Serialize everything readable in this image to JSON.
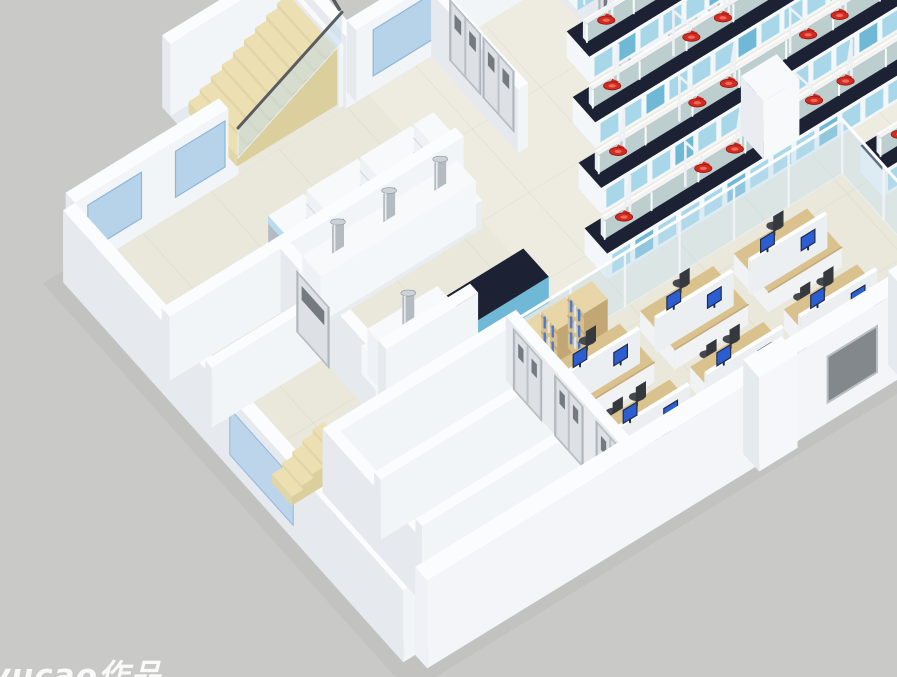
{
  "meta": {
    "description": "3D isometric cutaway render of a laboratory building floor plan: central lab hall with island benches and red fume-extraction arms, prep rooms with canopy hoods and chimney vents, top-right instrument rooms with a biosafety cabinet, an open-plan office with cubicle desks and monitors, corridor rooms with double doors, and two staircases.",
    "canvas": {
      "width": 897,
      "height": 677
    }
  },
  "watermark": {
    "text": "yucao作品",
    "color": "#ffffff"
  },
  "palette": {
    "background": "#c9c9c7",
    "shadow": "#bababa",
    "floor": "#eae7db",
    "floor_lab": "#f0eee3",
    "tile_line": "#d8d6c9",
    "wall_top": "#fbfcfe",
    "wall_left": "#e6eaef",
    "wall_front": "#f2f5f8",
    "wall_outer": "#eef1f5",
    "bench_top": "#1c2234",
    "bench_body": "#f3f7f9",
    "bench_blue": "#a7d7e9",
    "bench_teal": "#6fb9d6",
    "shelf_mint": "#d8ecea",
    "arm_white": "#eef1f3",
    "hood_red": "#d32b20",
    "hood_red_dark": "#9c1810",
    "hood_red_light": "#e96a5e",
    "glass": "#bfdcea",
    "glass_frame": "#e9eff3",
    "window_blue": "#b7d3ea",
    "window_blue_edge": "#8fb8d8",
    "window_gray": "#83888d",
    "door_face": "#dde1e5",
    "door_frame": "#aab1b7",
    "door_window": "#596066",
    "desk_tan": "#dac28f",
    "desk_edge": "#c3a978",
    "desk_body": "#f0f2f4",
    "partition": "#eceff2",
    "monitor_screen": "#2d5ed1",
    "monitor_dark": "#1f2c47",
    "chair": "#45494f",
    "chair_dark": "#35383d",
    "stair": "#ecdfb2",
    "stair_side": "#dccf9e",
    "stair_left": "#e2d5a8",
    "rail_dark": "#5a5d60",
    "wood": "#d8bf8b",
    "wood_dark": "#c2a674",
    "wood_top": "#e8d6a8",
    "book_blue": "#4a7bd4",
    "steel": "#b4bcc2",
    "steel_top": "#ccd3d8",
    "white": "#f7f9fb",
    "cab_blue": "#b8dcee",
    "cab_open": "#20283a"
  },
  "projection": {
    "origin": [
      75,
      275
    ],
    "u_axis": [
      0.852,
      -0.523
    ],
    "v_axis": [
      0.667,
      0.745
    ]
  },
  "building": {
    "length": 950,
    "width": 510,
    "wall_height": 72
  },
  "scene": {
    "stair_bay": {
      "u1": 180,
      "u2": 330,
      "v1": -99,
      "v2": 0,
      "steps": 9,
      "step_u0": 196,
      "step_du": 13,
      "sv1": -80,
      "sv2": -8,
      "rise": 5.5,
      "base_h": 6
    },
    "stairs_left": {
      "steps": 5,
      "u0": 8,
      "du": 12,
      "v1": 285,
      "v2": 315,
      "rise": 5,
      "base_h": 4
    },
    "nw_wall_segments": [
      [
        0,
        180
      ],
      [
        330,
        950
      ]
    ],
    "ext_windows": {
      "nw_u": [
        [
          15,
          78
        ],
        [
          118,
          176
        ],
        [
          350,
          420
        ],
        [
          588,
          640
        ],
        [
          694,
          746
        ],
        [
          804,
          856
        ],
        [
          900,
          944
        ]
      ],
      "sw_v": [
        [
          250,
          345
        ]
      ],
      "se_u": [
        [
          470,
          528
        ],
        [
          635,
          693
        ],
        [
          798,
          853
        ]
      ]
    },
    "interior_walls": {
      "upper": [
        [
          418,
          0,
          430,
          130,
          64
        ],
        [
          0,
          130,
          345,
          142,
          64
        ],
        [
          130,
          142,
          142,
          285,
          64
        ],
        [
          0,
          195,
          130,
          205,
          60
        ],
        [
          555,
          0,
          567,
          130,
          64
        ],
        [
          660,
          0,
          672,
          130,
          64
        ],
        [
          770,
          0,
          782,
          130,
          64
        ],
        [
          880,
          0,
          892,
          130,
          64
        ]
      ],
      "v130_segments": [
        [
          555,
          130,
          587,
          142,
          64
        ],
        [
          623,
          130,
          702,
          142,
          64
        ],
        [
          738,
          130,
          812,
          142,
          64
        ],
        [
          848,
          130,
          950,
          142,
          64
        ]
      ],
      "prep_south": [
        [
          142,
          273,
          250,
          285,
          64
        ]
      ],
      "lower": [
        [
          40,
          320,
          255,
          332,
          64
        ],
        [
          40,
          332,
          52,
          505,
          64
        ],
        [
          52,
          382,
          255,
          392,
          60
        ],
        [
          52,
          444,
          255,
          454,
          60
        ],
        [
          255,
          320,
          267,
          505,
          64
        ]
      ]
    },
    "doors_v": [
      {
        "u": 430,
        "v1": 16,
        "v2": 58,
        "double": true
      },
      {
        "u": 430,
        "v1": 66,
        "v2": 108,
        "double": true
      },
      {
        "u": 555,
        "v1": 80,
        "v2": 122,
        "double": false
      },
      {
        "u": 660,
        "v1": 80,
        "v2": 122,
        "double": false
      },
      {
        "u": 770,
        "v1": 80,
        "v2": 122,
        "double": false
      },
      {
        "u": 880,
        "v1": 80,
        "v2": 122,
        "double": false
      },
      {
        "u": 130,
        "v1": 170,
        "v2": 214,
        "double": false
      },
      {
        "u": 255,
        "v1": 335,
        "v2": 373,
        "double": true
      },
      {
        "u": 255,
        "v1": 397,
        "v2": 435,
        "double": true
      },
      {
        "u": 255,
        "v1": 459,
        "v2": 497,
        "double": true
      }
    ],
    "doors_u": [
      {
        "v": 130,
        "u1": 589,
        "u2": 621
      },
      {
        "v": 130,
        "u1": 704,
        "u2": 736
      },
      {
        "v": 130,
        "u1": 814,
        "u2": 846
      }
    ],
    "bench_rows": [
      {
        "v": 90,
        "u1": 520,
        "u2": 950,
        "hoods": [
          560,
          625,
          690,
          755,
          820,
          885
        ]
      },
      {
        "v": 150,
        "u1": 480,
        "u2": 950,
        "hoods": [
          520,
          585,
          650,
          715,
          780,
          845,
          910
        ]
      },
      {
        "v": 210,
        "u1": 440,
        "u2": 950,
        "hoods": [
          480,
          545,
          610,
          675,
          740,
          805,
          870
        ]
      },
      {
        "v": 270,
        "u1": 400,
        "u2": 880,
        "hoods": [
          440,
          505,
          570,
          635,
          700,
          765,
          830
        ]
      },
      {
        "v": 345,
        "u1": 665,
        "u2": 950,
        "hoods": [
          705,
          770,
          835,
          900
        ]
      },
      {
        "v": 405,
        "u1": 680,
        "u2": 950,
        "hoods": [
          720,
          785,
          850
        ]
      }
    ],
    "bench_half_width": 17,
    "bench_height": 26,
    "wall_benches": [
      {
        "u1": 560,
        "u2": 648,
        "v1": 8,
        "v2": 38
      },
      {
        "u1": 775,
        "u2": 948,
        "v1": 8,
        "v2": 38
      },
      {
        "u1": 700,
        "u2": 948,
        "v1": 470,
        "v2": 502
      }
    ],
    "biosafety_cabinet": {
      "u1": 652,
      "u2": 712,
      "v1": 6,
      "v2": 50,
      "h": 62
    },
    "fume_benches": [
      {
        "u1": 150,
        "u2": 340,
        "v1": 140,
        "v2": 176,
        "chimneys": [
          185,
          245,
          305
        ]
      },
      {
        "u1": 150,
        "u2": 240,
        "v1": 238,
        "v2": 276,
        "chimneys": [
          190
        ]
      }
    ],
    "prep_dark_bench": {
      "u1": 250,
      "u2": 340,
      "v1": 238,
      "v2": 276
    },
    "shelf_units": [
      {
        "u1": 195,
        "u2": 255,
        "v1": 98,
        "v2": 128
      },
      {
        "u1": 258,
        "u2": 318,
        "v1": 98,
        "v2": 128
      },
      {
        "u1": 321,
        "u2": 344,
        "v1": 98,
        "v2": 128
      }
    ],
    "steel_cabinet": {
      "u1": 150,
      "u2": 192,
      "v1": 98,
      "v2": 128
    },
    "fridge": {
      "u1": 600,
      "u2": 642,
      "v1": 232,
      "v2": 266,
      "h": 58
    },
    "glass_walls": [
      {
        "dir": "u",
        "v": 320,
        "u1": 267,
        "u2": 650,
        "h": 54
      },
      {
        "dir": "v",
        "u": 650,
        "v1": 320,
        "v2": 505,
        "h": 54
      }
    ],
    "bookshelves": [
      {
        "u1": 262,
        "u2": 290,
        "v1": 325,
        "v2": 349
      },
      {
        "u1": 293,
        "u2": 321,
        "v1": 325,
        "v2": 349
      },
      {
        "u1": 324,
        "u2": 352,
        "v1": 325,
        "v2": 349
      }
    ],
    "desk_modules": [
      {
        "u1": 278,
        "u2": 368,
        "vc": 375
      },
      {
        "u1": 388,
        "u2": 478,
        "vc": 375
      },
      {
        "u1": 498,
        "u2": 588,
        "vc": 375
      },
      {
        "u1": 278,
        "u2": 368,
        "vc": 450
      },
      {
        "u1": 388,
        "u2": 478,
        "vc": 450
      },
      {
        "u1": 498,
        "u2": 588,
        "vc": 450
      }
    ],
    "single_desks": [
      {
        "u1": 455,
        "u2": 530,
        "v1": 480,
        "v2": 504
      },
      {
        "u1": 545,
        "u2": 620,
        "v1": 480,
        "v2": 504
      },
      {
        "u1": 295,
        "u2": 375,
        "v1": 478,
        "v2": 502,
        "manager": true
      }
    ],
    "se_pilasters": [
      [
        385,
        510,
        430,
        534,
        94
      ],
      [
        555,
        510,
        600,
        534,
        94
      ],
      [
        720,
        510,
        765,
        534,
        94
      ]
    ]
  }
}
